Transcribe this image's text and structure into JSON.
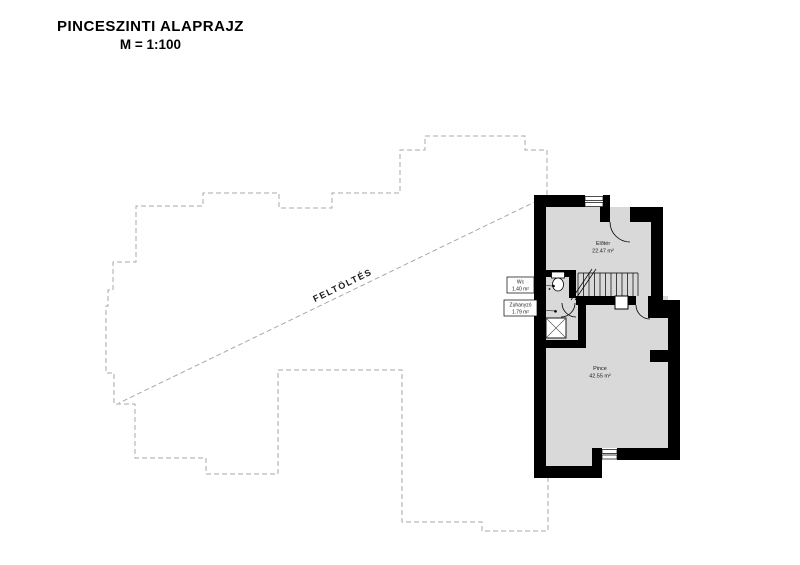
{
  "title": {
    "line1": "PINCESZINTI ALAPRAJZ",
    "line2": "M = 1:100"
  },
  "plan": {
    "fill_label": "FELTÖLTÉS",
    "rooms": [
      {
        "name": "Előtér",
        "area": "22.47 m²"
      },
      {
        "name": "Wc",
        "area": "1.40 m²"
      },
      {
        "name": "Zuhanyzó",
        "area": "1.79 m²"
      },
      {
        "name": "Pince",
        "area": "42.55 m²"
      }
    ],
    "colors": {
      "wall": "#000000",
      "floor": "#d9d9d9",
      "outline_dash": "#a9a9a9",
      "text": "#1a1a1a"
    }
  }
}
